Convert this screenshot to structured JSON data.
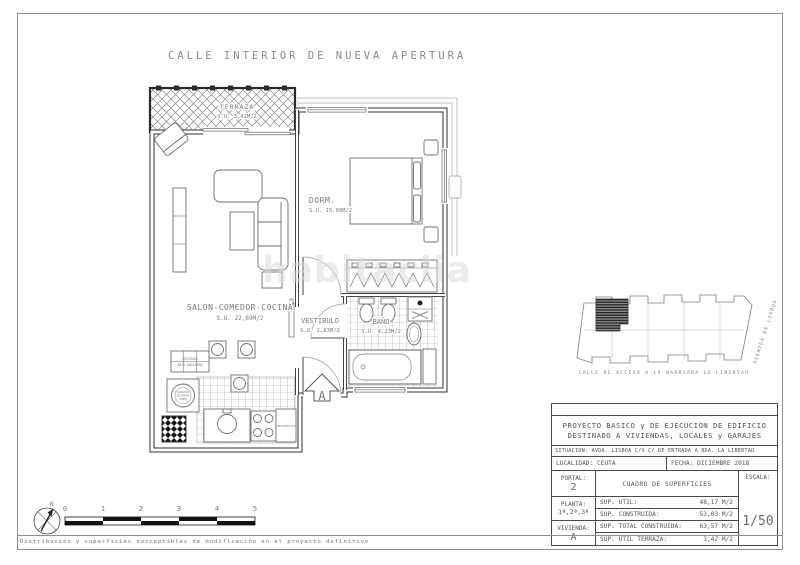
{
  "sheet": {
    "street_title": "CALLE INTERIOR DE NUEVA APERTURA",
    "disclaimer": "Distribución y superficies susceptibles de modificación en el proyecto definitivo",
    "watermark": "habitaclia"
  },
  "rooms": {
    "terraza": {
      "name": "TERRAZA",
      "area": "S.U. 3,42M/2"
    },
    "salon": {
      "name": "SALON-COMEDOR-COCINA",
      "area": "S.U. 22,69M/2"
    },
    "dorm": {
      "name": "DORM.",
      "area": "S.U. 15,00M/2"
    },
    "vestibulo": {
      "name": "VESTIBULO",
      "area": "S.U. 2,83M/2"
    },
    "bano": {
      "name": "BAÑO",
      "area": "S.U. 4,23M/2"
    }
  },
  "kitchen": {
    "frigorifico": "FRIGORIFICO",
    "residuos_line1": "RESIDUOS",
    "residuos_line2": "BAJO ENCIMERA",
    "lavadora_line1": "LAVADORA",
    "lavadora_line2": "SECADORA",
    "lavadora_line3": "TERMO"
  },
  "entrance": {
    "section_marker": "A"
  },
  "compass": {
    "north_label": "N"
  },
  "scalebar": {
    "ticks": [
      "0",
      "1",
      "2",
      "3",
      "4",
      "5"
    ]
  },
  "siteplan": {
    "street_bottom": "CALLE DE ACCESO A LA BARRIADA LA LIBERTAD",
    "street_right": "AVENIDA DE LISBOA"
  },
  "titleblock": {
    "project_line1": "PROYECTO BASICO y DE EJECUCION DE EDIFICIO",
    "project_line2": "DESTINADO A VIVIENDAS, LOCALES y GARAJES",
    "situacion": "SITUACION: AVDA. LISBOA C/V C/ DE ENTRADA A BDA. LA LIBERTAD",
    "localidad_label": "LOCALIDAD:",
    "localidad": "CEUTA",
    "fecha_label": "FECHA:",
    "fecha": "DICIEMBRE 2018",
    "portal_label": "PORTAL:",
    "portal": "2",
    "cuadro_title": "CUADRO DE SUPERFICIES",
    "escala_label": "ESCALA:",
    "escala": "1/50",
    "planta_label": "PLANTA:",
    "planta": "1ª,2ª,3ª",
    "vivienda_label": "VIVIENDA:",
    "vivienda": "A",
    "rows": [
      {
        "label": "SUP. UTIL:",
        "value": "48,17 M/2"
      },
      {
        "label": "SUP. CONSTRUIDA:",
        "value": "53,03 M/2"
      },
      {
        "label": "SUP. TOTAL CONSTRUIDA:",
        "value": "63,57 M/2"
      },
      {
        "label": "SUP. UTIL TERRAZA:",
        "value": "3,42 M/2"
      }
    ]
  }
}
